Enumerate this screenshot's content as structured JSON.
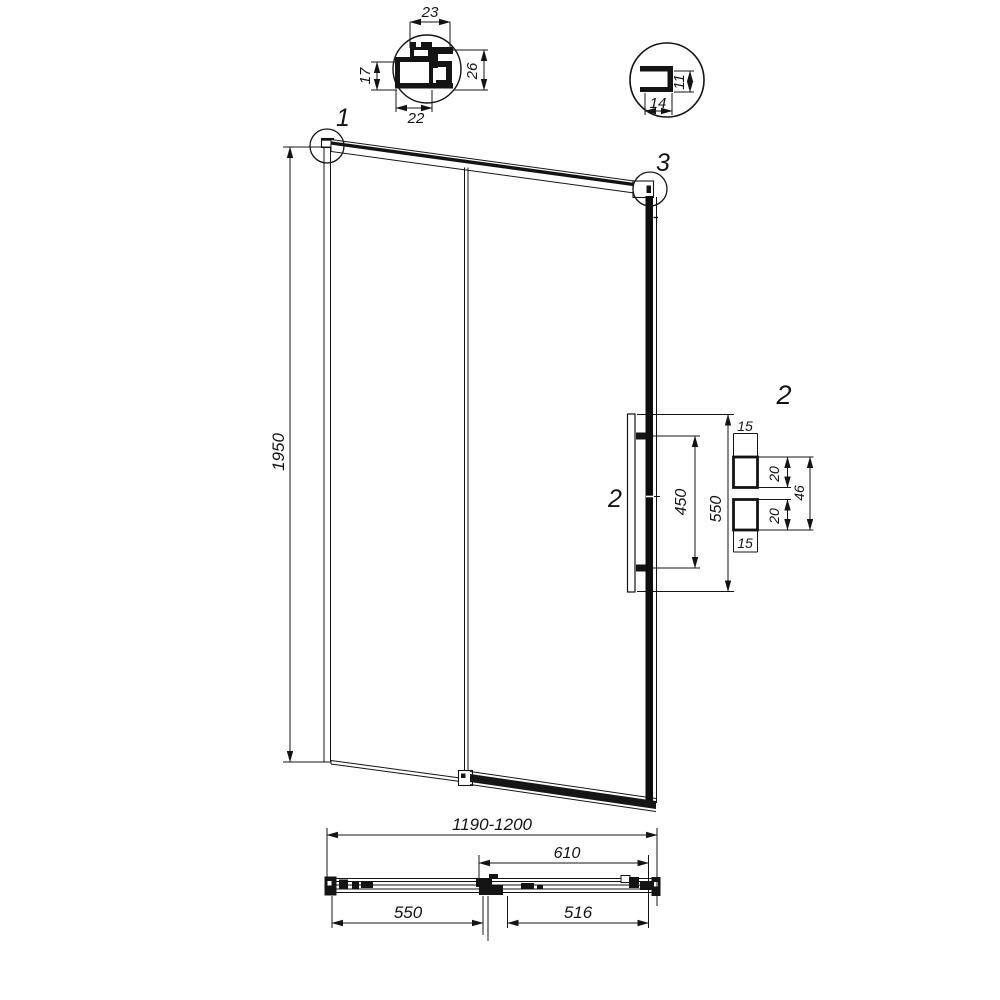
{
  "drawing": {
    "profile_detail_a": {
      "width_top": "23",
      "height_left": "17",
      "height_right": "26",
      "width_bottom": "22"
    },
    "profile_detail_b": {
      "height_right": "11",
      "width_bottom": "14"
    },
    "elevation": {
      "height": "1950",
      "callout_top_left": "1",
      "callout_top_right": "3",
      "callout_handle": "2"
    },
    "handle_detail": {
      "label": "2",
      "length_overall": "550",
      "hole_spacing": "450",
      "end_offset_top": "15",
      "pad_size_top": "20",
      "pad_span": "46",
      "pad_size_bottom": "20",
      "end_offset_bottom": "15"
    },
    "plan": {
      "width_overall": "1190-1200",
      "door_panel": "610",
      "fixed_panel": "550",
      "opening": "516"
    }
  }
}
